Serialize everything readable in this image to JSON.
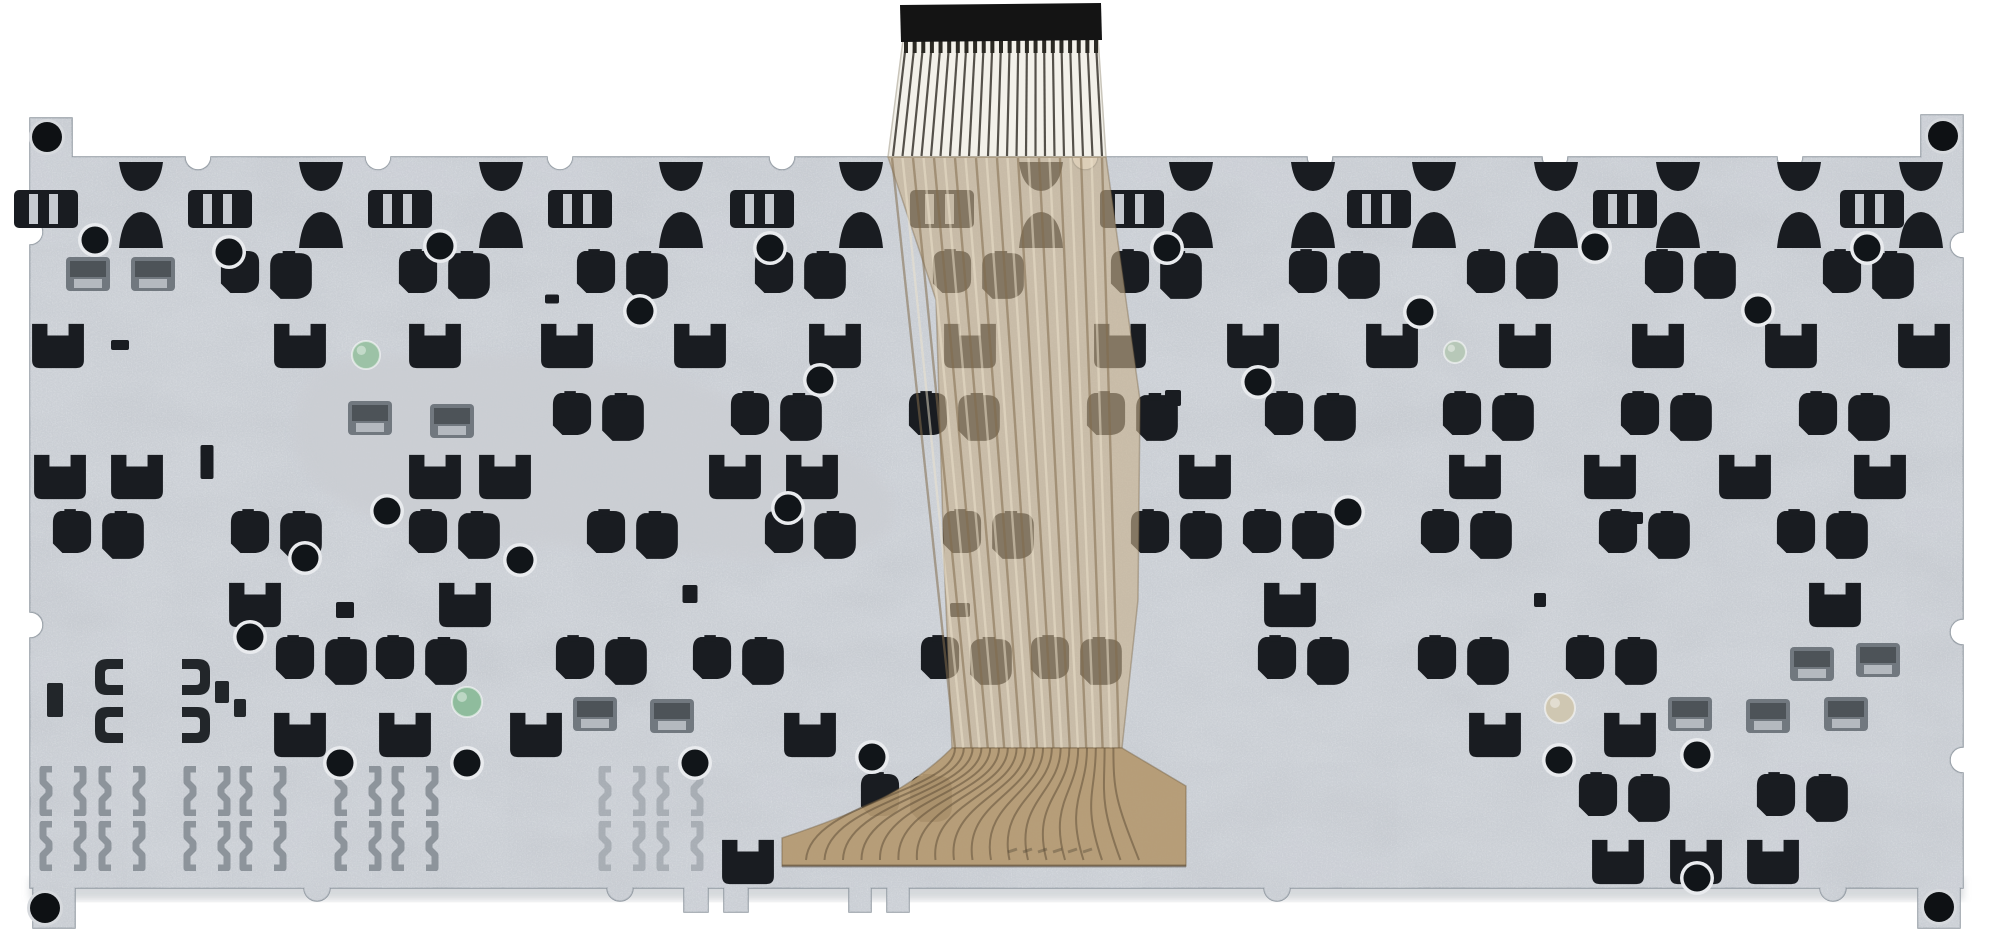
{
  "scene": {
    "subject": "rear side of a laptop keyboard metal backplate with flex ribbon cable",
    "background": "#ffffff",
    "width": 2000,
    "height": 948
  },
  "palette": {
    "plate": "#c7cbd1",
    "plate_edge": "#9199a1",
    "speckle_dark": "#8f959d",
    "speckle_light": "#eef0f3",
    "patch": "#cbced3",
    "clip_dark": "#191c21",
    "clip_gray": "#70777e",
    "spring": "#8d949b",
    "bracket": "#22262a",
    "dot": "#111519",
    "dot_rim": "#e9ebee",
    "screw": "#0e1114",
    "cable_top": "#f3f1ea",
    "cable_line": "#55514a",
    "stiffener": "#141414",
    "cable_tan": "rgba(198,176,141,0.62)",
    "cable_stripe_dark": "rgba(130,108,76,0.55)",
    "cable_stripe_light": "rgba(238,228,206,0.5)",
    "cable_fan": "#b59a72",
    "fan_trace": "rgba(90,74,52,0.5)",
    "shadow": "#b4b9bf"
  },
  "plate": {
    "x": 30,
    "y": 157,
    "right": 1963,
    "bottom": 888,
    "notch_r": 13,
    "top_notches": [
      198,
      378,
      560,
      782,
      1085,
      1320,
      1555,
      1790
    ],
    "right_notches": [
      245,
      632,
      760
    ],
    "bottom_notches": [
      1833,
      1277,
      620,
      317
    ],
    "left_notches": [
      625,
      232
    ],
    "corner_tab_w": 42,
    "bottom_tabs": [
      {
        "x": 887,
        "w": 22,
        "d": 24
      },
      {
        "x": 849,
        "w": 22,
        "d": 24
      },
      {
        "x": 724,
        "w": 24,
        "d": 24
      },
      {
        "x": 684,
        "w": 24,
        "d": 24
      }
    ],
    "screws": [
      [
        47,
        137
      ],
      [
        1943,
        136
      ],
      [
        45,
        908
      ],
      [
        1939,
        907
      ]
    ],
    "patch_path": "M295,420 C300,370 330,358 390,356 C470,352 560,356 640,368 C700,378 762,412 832,446 C882,468 904,500 888,530 C860,560 780,562 700,556 C600,548 480,544 390,522 C320,505 290,462 295,420 Z"
  },
  "clips": {
    "iii_row": {
      "y": 207,
      "xs": [
        44,
        218,
        398,
        578,
        760,
        940,
        1130,
        1377,
        1623,
        1870
      ]
    },
    "bowtie_row": {
      "y": 205,
      "xs": [
        140,
        320,
        500,
        680,
        860,
        1040,
        1190,
        1312,
        1433,
        1555,
        1677,
        1798,
        1920
      ]
    },
    "blob_rows": [
      {
        "y": 272,
        "pairs": [
          265,
          443,
          621,
          799,
          977,
          1155,
          1333,
          1511,
          1689,
          1867
        ]
      },
      {
        "y": 414,
        "pairs": [
          597,
          775,
          953,
          1131,
          1309,
          1487,
          1665,
          1843
        ]
      },
      {
        "y": 532,
        "pairs": [
          97,
          275,
          453,
          631,
          809,
          987,
          1175,
          1287,
          1465,
          1643,
          1821
        ]
      },
      {
        "y": 658,
        "pairs": [
          320,
          420,
          600,
          737,
          965,
          1075,
          1302,
          1462,
          1610
        ]
      },
      {
        "y": 795,
        "pairs": [
          905,
          1623,
          1801
        ]
      }
    ],
    "m_rows": [
      {
        "y": 346,
        "xs": [
          58,
          300,
          435,
          567,
          700,
          835,
          970,
          1120,
          1253,
          1392,
          1525,
          1658,
          1791,
          1924
        ]
      },
      {
        "y": 477,
        "xs": [
          60,
          137,
          435,
          505,
          735,
          812,
          1205,
          1475,
          1610,
          1745,
          1880
        ]
      },
      {
        "y": 605,
        "xs": [
          255,
          465,
          1290,
          1835
        ]
      },
      {
        "y": 735,
        "xs": [
          300,
          405,
          536,
          810,
          1495,
          1630
        ]
      },
      {
        "y": 862,
        "xs": [
          748,
          1618,
          1696,
          1773
        ]
      }
    ],
    "latches": [
      [
        88,
        272
      ],
      [
        153,
        272
      ],
      [
        370,
        416
      ],
      [
        452,
        419
      ],
      [
        1812,
        662
      ],
      [
        1878,
        658
      ],
      [
        595,
        712
      ],
      [
        672,
        714
      ],
      [
        1690,
        712
      ],
      [
        1768,
        714
      ],
      [
        1846,
        712
      ]
    ],
    "bracket_cluster": {
      "cols": [
        110,
        195
      ],
      "y": 700,
      "bits": [
        [
          55,
          700,
          16,
          34
        ],
        [
          222,
          692,
          14,
          22
        ],
        [
          240,
          708,
          12,
          18
        ]
      ]
    },
    "springs": {
      "cols": [
        63,
        122,
        207,
        263,
        358,
        415
      ],
      "faded_cols": [
        622,
        680
      ],
      "ys": [
        790,
        845
      ]
    },
    "bits": [
      [
        1173,
        398,
        16,
        16
      ],
      [
        552,
        299,
        14,
        9
      ],
      [
        207,
        462,
        13,
        34
      ],
      [
        1637,
        518,
        12,
        12
      ],
      [
        120,
        345,
        18,
        10
      ],
      [
        690,
        594,
        15,
        18
      ],
      [
        1540,
        600,
        12,
        14
      ],
      [
        345,
        610,
        18,
        16
      ],
      [
        960,
        610,
        20,
        14
      ]
    ],
    "dots": [
      [
        95,
        240
      ],
      [
        229,
        252
      ],
      [
        440,
        246
      ],
      [
        770,
        248
      ],
      [
        1167,
        248
      ],
      [
        1595,
        247
      ],
      [
        1867,
        248
      ],
      [
        640,
        311
      ],
      [
        1420,
        312
      ],
      [
        1758,
        310
      ],
      [
        820,
        380
      ],
      [
        1258,
        382
      ],
      [
        387,
        511
      ],
      [
        788,
        508
      ],
      [
        1348,
        512
      ],
      [
        305,
        558
      ],
      [
        520,
        560
      ],
      [
        250,
        637
      ],
      [
        695,
        763
      ],
      [
        340,
        763
      ],
      [
        467,
        763
      ],
      [
        872,
        757
      ],
      [
        1559,
        760
      ],
      [
        1697,
        755
      ],
      [
        1697,
        878
      ]
    ],
    "stickers": [
      {
        "x": 366,
        "y": 355,
        "r": 14,
        "color": "#9cc2a6"
      },
      {
        "x": 1455,
        "y": 352,
        "r": 11,
        "color": "#b7c8b8"
      },
      {
        "x": 467,
        "y": 702,
        "r": 15,
        "color": "#8fbc9d"
      },
      {
        "x": 1560,
        "y": 708,
        "r": 15,
        "color": "#cfc7b2"
      }
    ]
  },
  "cable": {
    "stiffener": [
      [
        900,
        5
      ],
      [
        1101,
        3
      ],
      [
        1102,
        40
      ],
      [
        901,
        42
      ]
    ],
    "top_section": [
      [
        903,
        40
      ],
      [
        1098,
        38
      ],
      [
        1106,
        157
      ],
      [
        888,
        157
      ]
    ],
    "top_lines": 23,
    "body": [
      [
        888,
        157
      ],
      [
        1106,
        157
      ],
      [
        1140,
        400
      ],
      [
        1138,
        600
      ],
      [
        1122,
        748
      ],
      [
        952,
        748
      ],
      [
        944,
        560
      ],
      [
        936,
        300
      ]
    ],
    "body_lines": 21,
    "fan_path": "M952,748 L1122,748 L1186,786 L1186,866 L782,866 L782,838 C860,812 910,790 952,748 Z",
    "fan_traces": 19,
    "marking": {
      "x": 1008,
      "y": 852,
      "strokes": 6,
      "note": "faint illegible embossed marking"
    }
  }
}
